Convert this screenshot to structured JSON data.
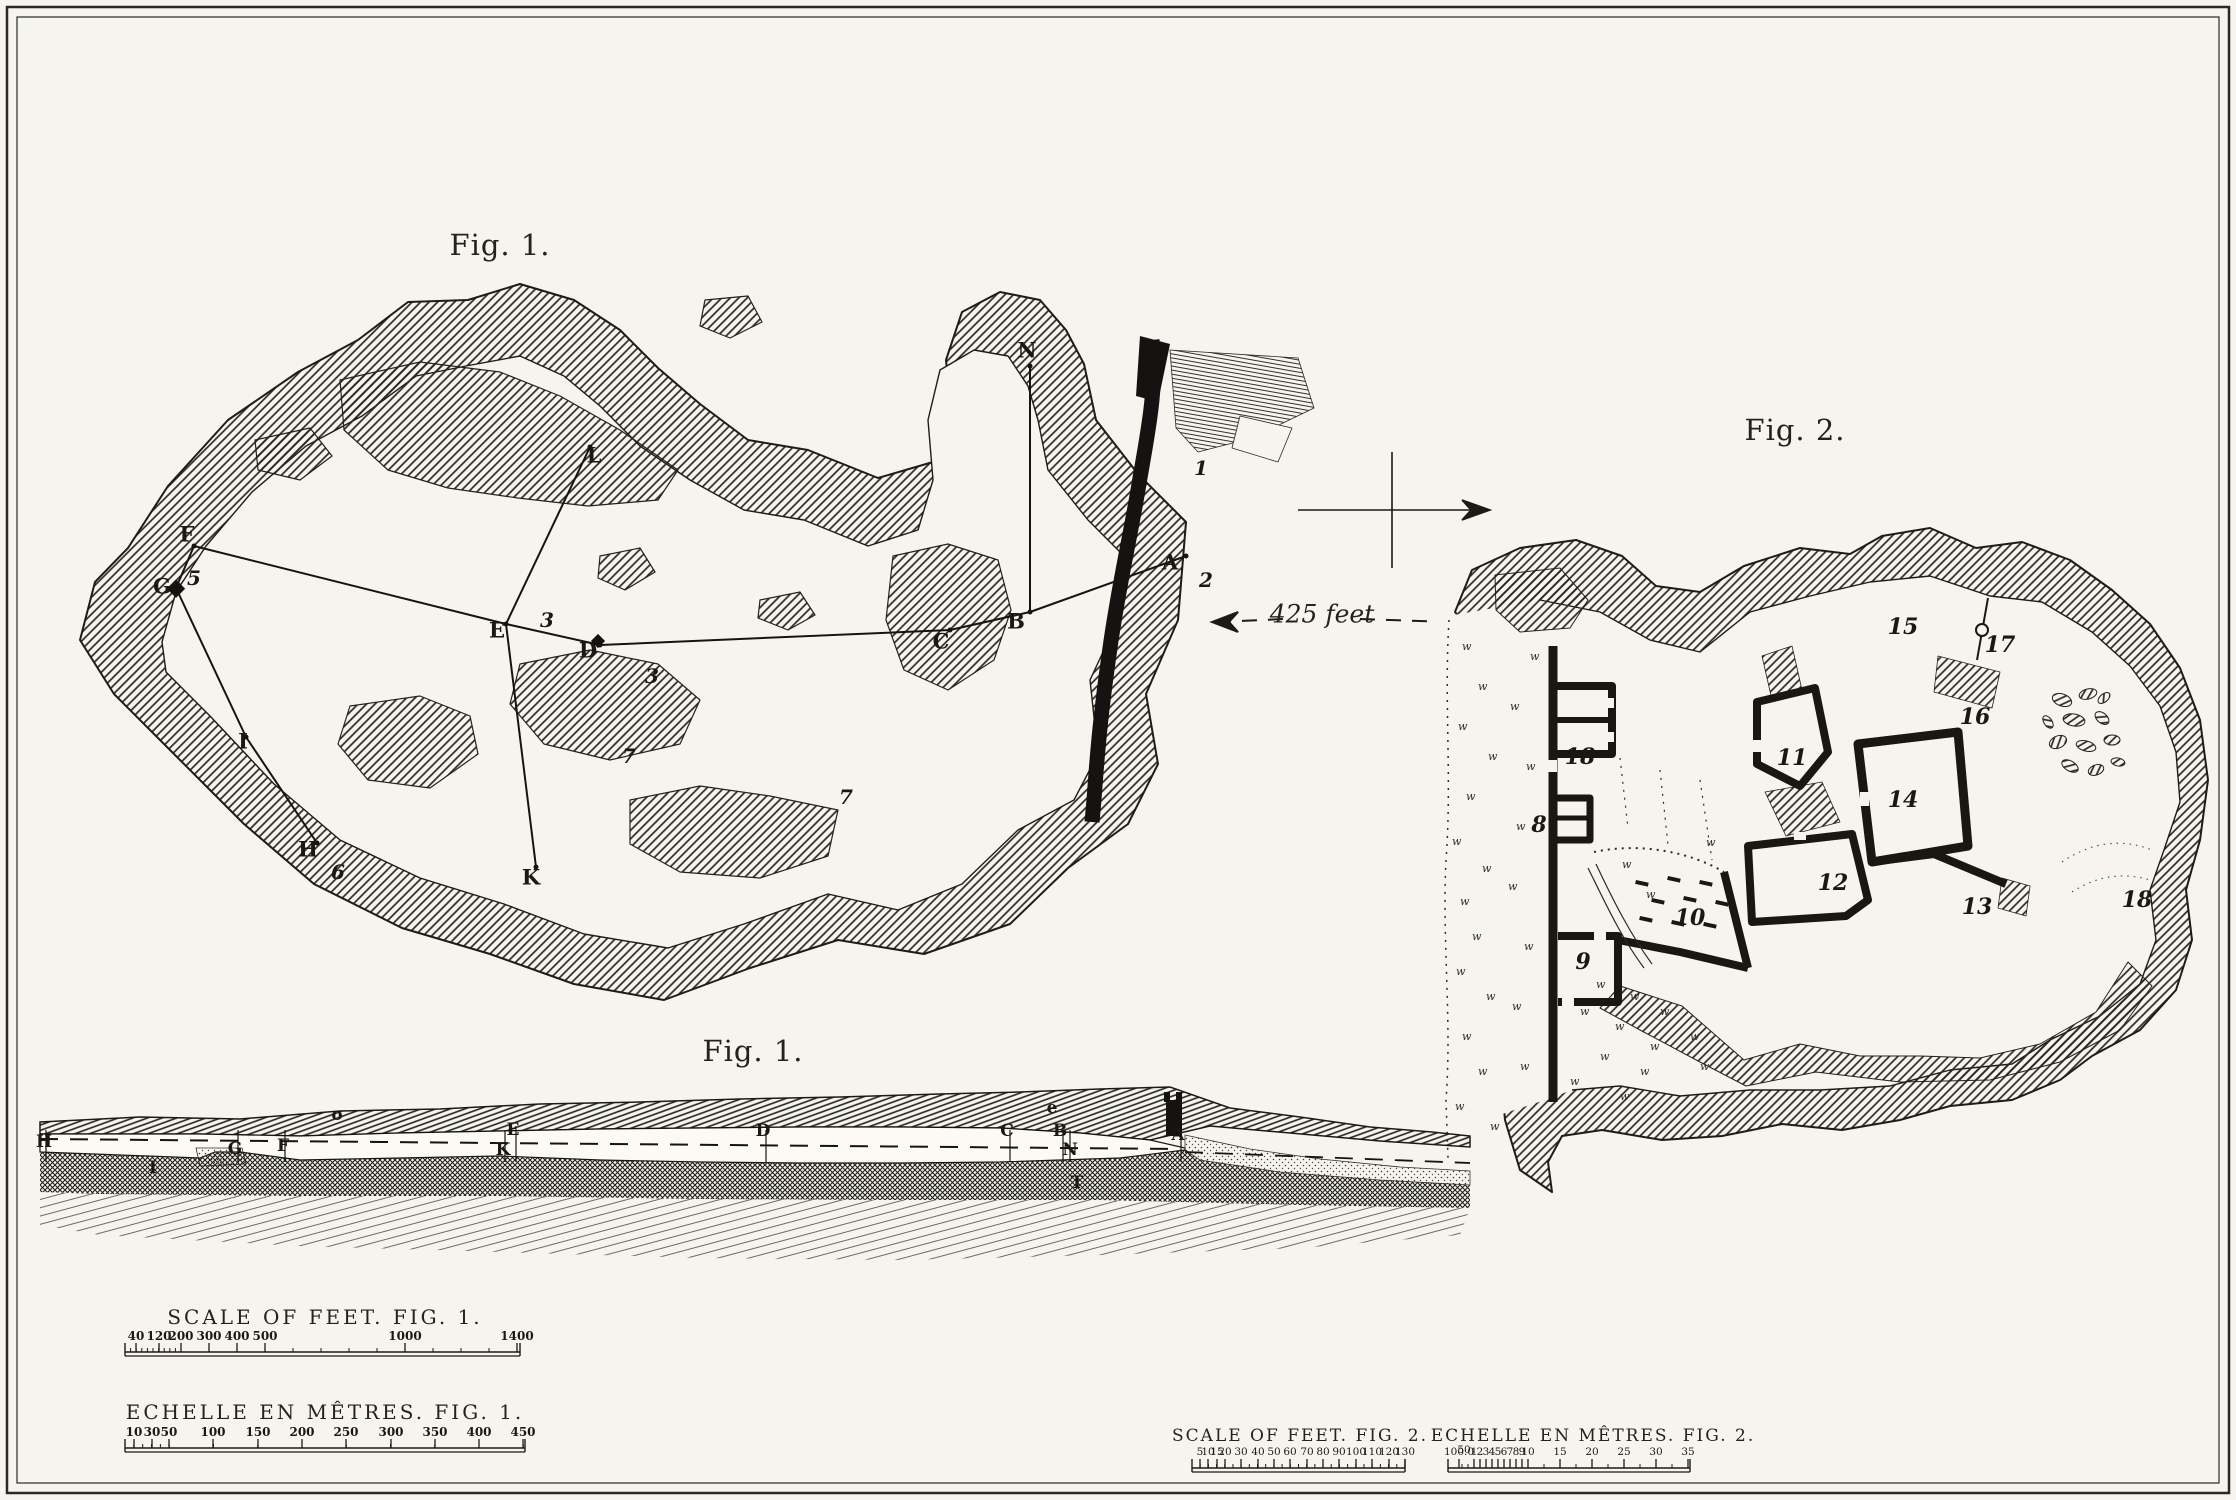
{
  "captions": {
    "fig1_plan": "Fig. 1.",
    "fig1_section": "Fig. 1.",
    "fig2": "Fig. 2.",
    "distance": "425 feet"
  },
  "fig1_plan": {
    "stations": [
      {
        "label": "N",
        "x": 1027,
        "y": 350
      },
      {
        "label": "L",
        "x": 594,
        "y": 455
      },
      {
        "label": "F",
        "x": 187,
        "y": 534
      },
      {
        "label": "G",
        "x": 162,
        "y": 586
      },
      {
        "label": "E",
        "x": 497,
        "y": 630
      },
      {
        "label": "D",
        "x": 588,
        "y": 650
      },
      {
        "label": "C",
        "x": 941,
        "y": 641
      },
      {
        "label": "B",
        "x": 1016,
        "y": 621
      },
      {
        "label": "A",
        "x": 1170,
        "y": 562
      },
      {
        "label": "I",
        "x": 243,
        "y": 741
      },
      {
        "label": "H",
        "x": 308,
        "y": 849
      },
      {
        "label": "K",
        "x": 531,
        "y": 877
      }
    ],
    "numbers": [
      {
        "label": "1",
        "x": 1201,
        "y": 468
      },
      {
        "label": "2",
        "x": 1206,
        "y": 580
      },
      {
        "label": "3",
        "x": 547,
        "y": 620
      },
      {
        "label": "3",
        "x": 652,
        "y": 676
      },
      {
        "label": "5",
        "x": 194,
        "y": 578
      },
      {
        "label": "6",
        "x": 338,
        "y": 872
      },
      {
        "label": "7",
        "x": 629,
        "y": 756
      },
      {
        "label": "7",
        "x": 846,
        "y": 797
      }
    ]
  },
  "fig1_section": {
    "labels": [
      {
        "label": "H",
        "x": 44,
        "y": 1142
      },
      {
        "label": "I",
        "x": 153,
        "y": 1168
      },
      {
        "label": "G",
        "x": 235,
        "y": 1149
      },
      {
        "label": "F",
        "x": 283,
        "y": 1146
      },
      {
        "label": "o",
        "x": 337,
        "y": 1115
      },
      {
        "label": "E",
        "x": 513,
        "y": 1130
      },
      {
        "label": "K",
        "x": 503,
        "y": 1150
      },
      {
        "label": "D",
        "x": 763,
        "y": 1131
      },
      {
        "label": "e",
        "x": 1052,
        "y": 1108
      },
      {
        "label": "C",
        "x": 1007,
        "y": 1131
      },
      {
        "label": "B",
        "x": 1060,
        "y": 1131
      },
      {
        "label": "N",
        "x": 1070,
        "y": 1150
      },
      {
        "label": "A",
        "x": 1178,
        "y": 1135
      },
      {
        "label": "T",
        "x": 1077,
        "y": 1183
      }
    ]
  },
  "fig2_plan": {
    "room_numbers": [
      {
        "label": "8",
        "x": 1539,
        "y": 825
      },
      {
        "label": "9",
        "x": 1583,
        "y": 962
      },
      {
        "label": "10",
        "x": 1690,
        "y": 918
      },
      {
        "label": "11",
        "x": 1792,
        "y": 758
      },
      {
        "label": "12",
        "x": 1833,
        "y": 883
      },
      {
        "label": "13",
        "x": 1977,
        "y": 907
      },
      {
        "label": "14",
        "x": 1903,
        "y": 800
      },
      {
        "label": "15",
        "x": 1903,
        "y": 627
      },
      {
        "label": "16",
        "x": 1975,
        "y": 717
      },
      {
        "label": "17",
        "x": 2000,
        "y": 645
      },
      {
        "label": "18",
        "x": 1580,
        "y": 757
      },
      {
        "label": "18",
        "x": 2137,
        "y": 900
      }
    ]
  },
  "scale_bars": {
    "feet1": {
      "title": "SCALE OF FEET. FIG. 1.",
      "ticks": [
        {
          "label": "40",
          "x": 136
        },
        {
          "label": "120",
          "x": 159
        },
        {
          "label": "200",
          "x": 181
        },
        {
          "label": "300",
          "x": 209
        },
        {
          "label": "400",
          "x": 237
        },
        {
          "label": "500",
          "x": 265
        },
        {
          "label": "1000",
          "x": 405
        },
        {
          "label": "1400",
          "x": 517
        }
      ]
    },
    "metres1": {
      "title": "ECHELLE EN MÊTRES. FIG. 1.",
      "ticks": [
        {
          "label": "10",
          "x": 134
        },
        {
          "label": "30",
          "x": 152
        },
        {
          "label": "50",
          "x": 169
        },
        {
          "label": "100",
          "x": 213
        },
        {
          "label": "150",
          "x": 258
        },
        {
          "label": "200",
          "x": 302
        },
        {
          "label": "250",
          "x": 346
        },
        {
          "label": "300",
          "x": 391
        },
        {
          "label": "350",
          "x": 435
        },
        {
          "label": "400",
          "x": 479
        },
        {
          "label": "450",
          "x": 523
        }
      ]
    },
    "feet2": {
      "title": "SCALE OF FEET. FIG. 2.",
      "ticks": [
        {
          "label": "5",
          "x": 1200
        },
        {
          "label": "10",
          "x": 1208
        },
        {
          "label": "15",
          "x": 1217
        },
        {
          "label": "20",
          "x": 1225
        },
        {
          "label": "30",
          "x": 1241
        },
        {
          "label": "40",
          "x": 1258
        },
        {
          "label": "50",
          "x": 1274
        },
        {
          "label": "60",
          "x": 1290
        },
        {
          "label": "70",
          "x": 1307
        },
        {
          "label": "80",
          "x": 1323
        },
        {
          "label": "90",
          "x": 1339
        },
        {
          "label": "100",
          "x": 1356
        },
        {
          "label": "110",
          "x": 1372
        },
        {
          "label": "120",
          "x": 1389
        },
        {
          "label": "130",
          "x": 1405
        }
      ]
    },
    "metres2": {
      "title": "ECHELLE EN MÊTRES. FIG. 2.",
      "ticks": [
        {
          "label": "50",
          "x": 1464,
          "small": true
        },
        {
          "label": "100.0",
          "x": 1459
        },
        {
          "label": "1",
          "x": 1474
        },
        {
          "label": "2",
          "x": 1480
        },
        {
          "label": "3",
          "x": 1486
        },
        {
          "label": "4",
          "x": 1492
        },
        {
          "label": "5",
          "x": 1498
        },
        {
          "label": "6",
          "x": 1504
        },
        {
          "label": "7",
          "x": 1510
        },
        {
          "label": "8",
          "x": 1516
        },
        {
          "label": "9",
          "x": 1522
        },
        {
          "label": "10",
          "x": 1528
        },
        {
          "label": "15",
          "x": 1560
        },
        {
          "label": "20",
          "x": 1592
        },
        {
          "label": "25",
          "x": 1624
        },
        {
          "label": "30",
          "x": 1656
        },
        {
          "label": "35",
          "x": 1688
        }
      ]
    }
  }
}
